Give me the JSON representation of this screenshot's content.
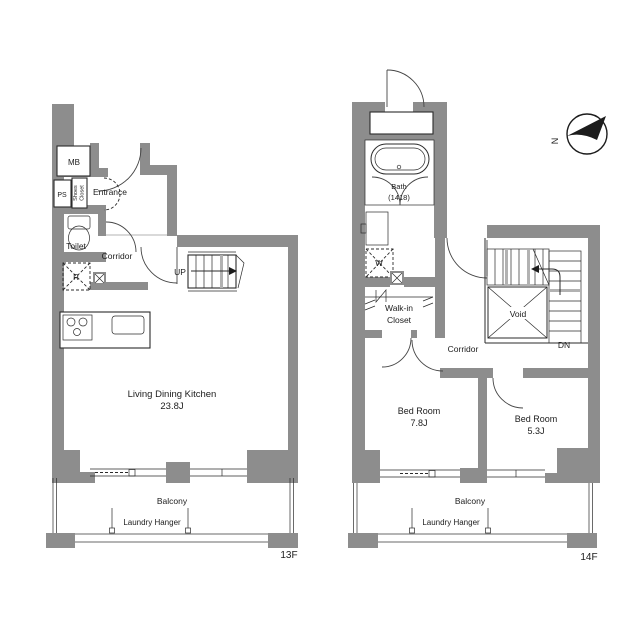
{
  "palette": {
    "wall_gray": "#8d8d8d",
    "line": "#2b2b2b",
    "background": "#ffffff"
  },
  "compass": {
    "north": "N"
  },
  "floor13": {
    "floor_label": "13F",
    "mb": "MB",
    "ps": "PS",
    "shoes_l1": "Shoes",
    "shoes_l2": "Closet",
    "entrance": "Entrance",
    "toilet": "Toilet",
    "corridor": "Corridor",
    "fridge": "R",
    "up": "UP",
    "ldk_l1": "Living Dining Kitchen",
    "ldk_l2": "23.8J",
    "balcony": "Balcony",
    "laundry": "Laundry Hanger"
  },
  "floor14": {
    "floor_label": "14F",
    "bath_l1": "Bath",
    "bath_l2": "(1418)",
    "washer": "W",
    "wic_l1": "Walk-in",
    "wic_l2": "Closet",
    "corridor": "Corridor",
    "void": "Void",
    "dn": "DN",
    "bed1_l1": "Bed Room",
    "bed1_l2": "7.8J",
    "bed2_l1": "Bed Room",
    "bed2_l2": "5.3J",
    "balcony": "Balcony",
    "laundry": "Laundry Hanger"
  }
}
